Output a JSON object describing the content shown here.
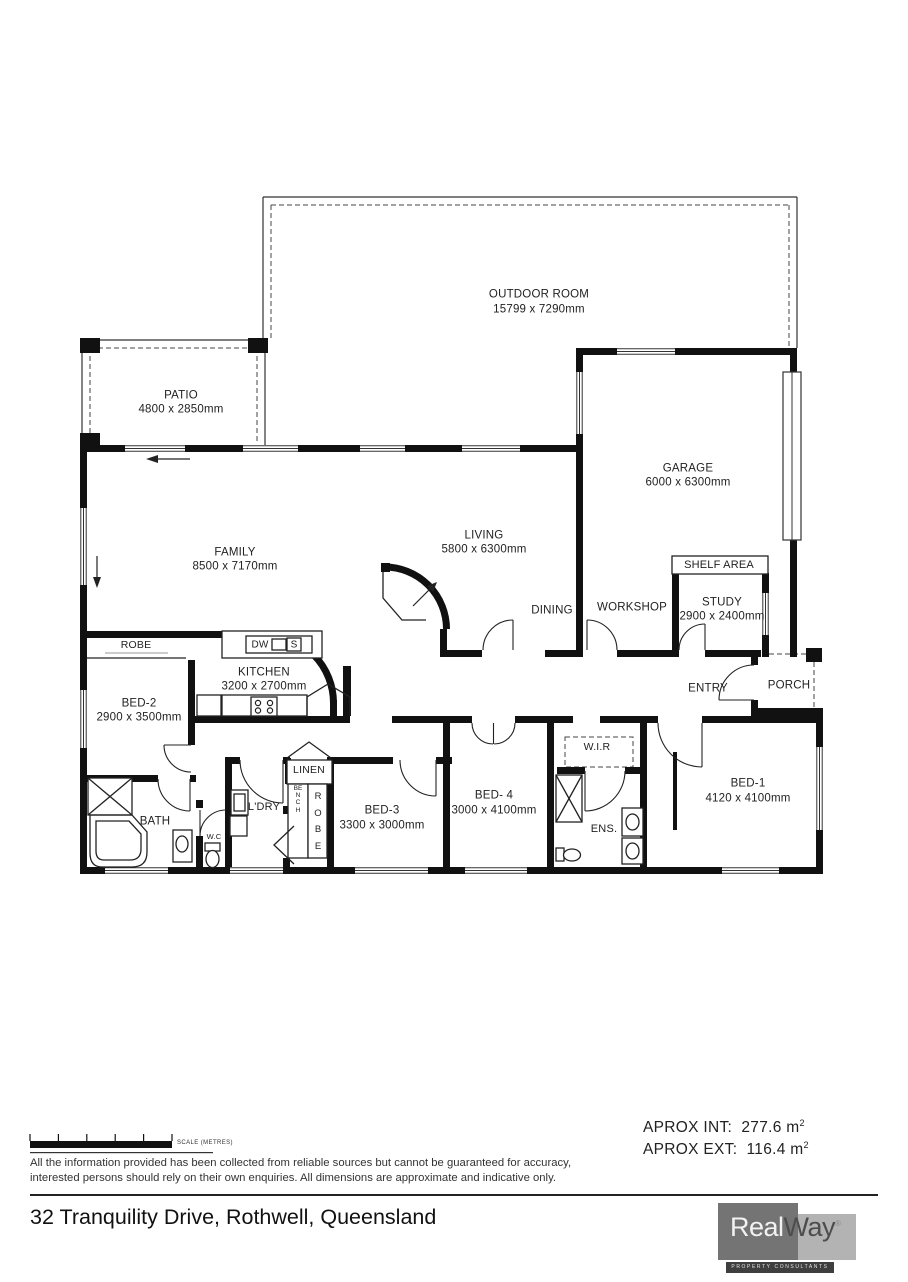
{
  "rooms": {
    "outdoor": {
      "label": "OUTDOOR ROOM",
      "dims": "15799 x 7290mm"
    },
    "patio": {
      "label": "PATIO",
      "dims": "4800 x 2850mm"
    },
    "garage": {
      "label": "GARAGE",
      "dims": "6000 x 6300mm"
    },
    "family": {
      "label": "FAMILY",
      "dims": "8500 x 7170mm"
    },
    "living": {
      "label": "LIVING",
      "dims": "5800 x 6300mm"
    },
    "dining": {
      "label": "DINING"
    },
    "workshop": {
      "label": "WORKSHOP"
    },
    "shelf_area": {
      "label": "SHELF AREA"
    },
    "study": {
      "label": "STUDY",
      "dims": "2900 x 2400mm"
    },
    "robe_bed2": {
      "label": "ROBE"
    },
    "kitchen": {
      "label": "KITCHEN",
      "dims": "3200 x 2700mm"
    },
    "bed2": {
      "label": "BED-2",
      "dims": "2900 x 3500mm"
    },
    "entry": {
      "label": "ENTRY"
    },
    "porch": {
      "label": "PORCH"
    },
    "wir": {
      "label": "W.I.R"
    },
    "linen": {
      "label": "LINEN"
    },
    "bench": {
      "label": "BENCH"
    },
    "robe_hall": {
      "label": "ROBE"
    },
    "ldry": {
      "label": "L'DRY"
    },
    "bath": {
      "label": "BATH"
    },
    "wc": {
      "label": "W.C"
    },
    "bed3": {
      "label": "BED-3",
      "dims": "3300 x 3000mm"
    },
    "bed4": {
      "label": "BED- 4",
      "dims": "3000 x 4100mm"
    },
    "ens": {
      "label": "ENS."
    },
    "bed1": {
      "label": "BED-1",
      "dims": "4120 x 4100mm"
    }
  },
  "kitchen_fixtures": {
    "dishwasher": "DW",
    "sink": "S"
  },
  "footer": {
    "scale_label": "SCALE (METRES)",
    "disclaimer_line1": "All the information provided has been collected from reliable sources but cannot be guaranteed for accuracy,",
    "disclaimer_line2": "interested persons should rely on their own enquiries. All dimensions are approximate and indicative only.",
    "approx_int_label": "APROX INT:",
    "approx_int_value": "277.6 m",
    "approx_int_sup": "2",
    "approx_ext_label": "APROX EXT:",
    "approx_ext_value": "116.4 m",
    "approx_ext_sup": "2",
    "address": "32 Tranquility Drive, Rothwell, Queensland"
  },
  "logo": {
    "brand_real": "Real",
    "brand_way": "Way",
    "registered": "®",
    "tagline": "PROPERTY CONSULTANTS"
  },
  "colors": {
    "wall": "#111111",
    "text": "#222222",
    "logo_dark_box": "#747474",
    "logo_light_box": "#b3b3b3",
    "logo_bar": "#3f3f3f"
  }
}
